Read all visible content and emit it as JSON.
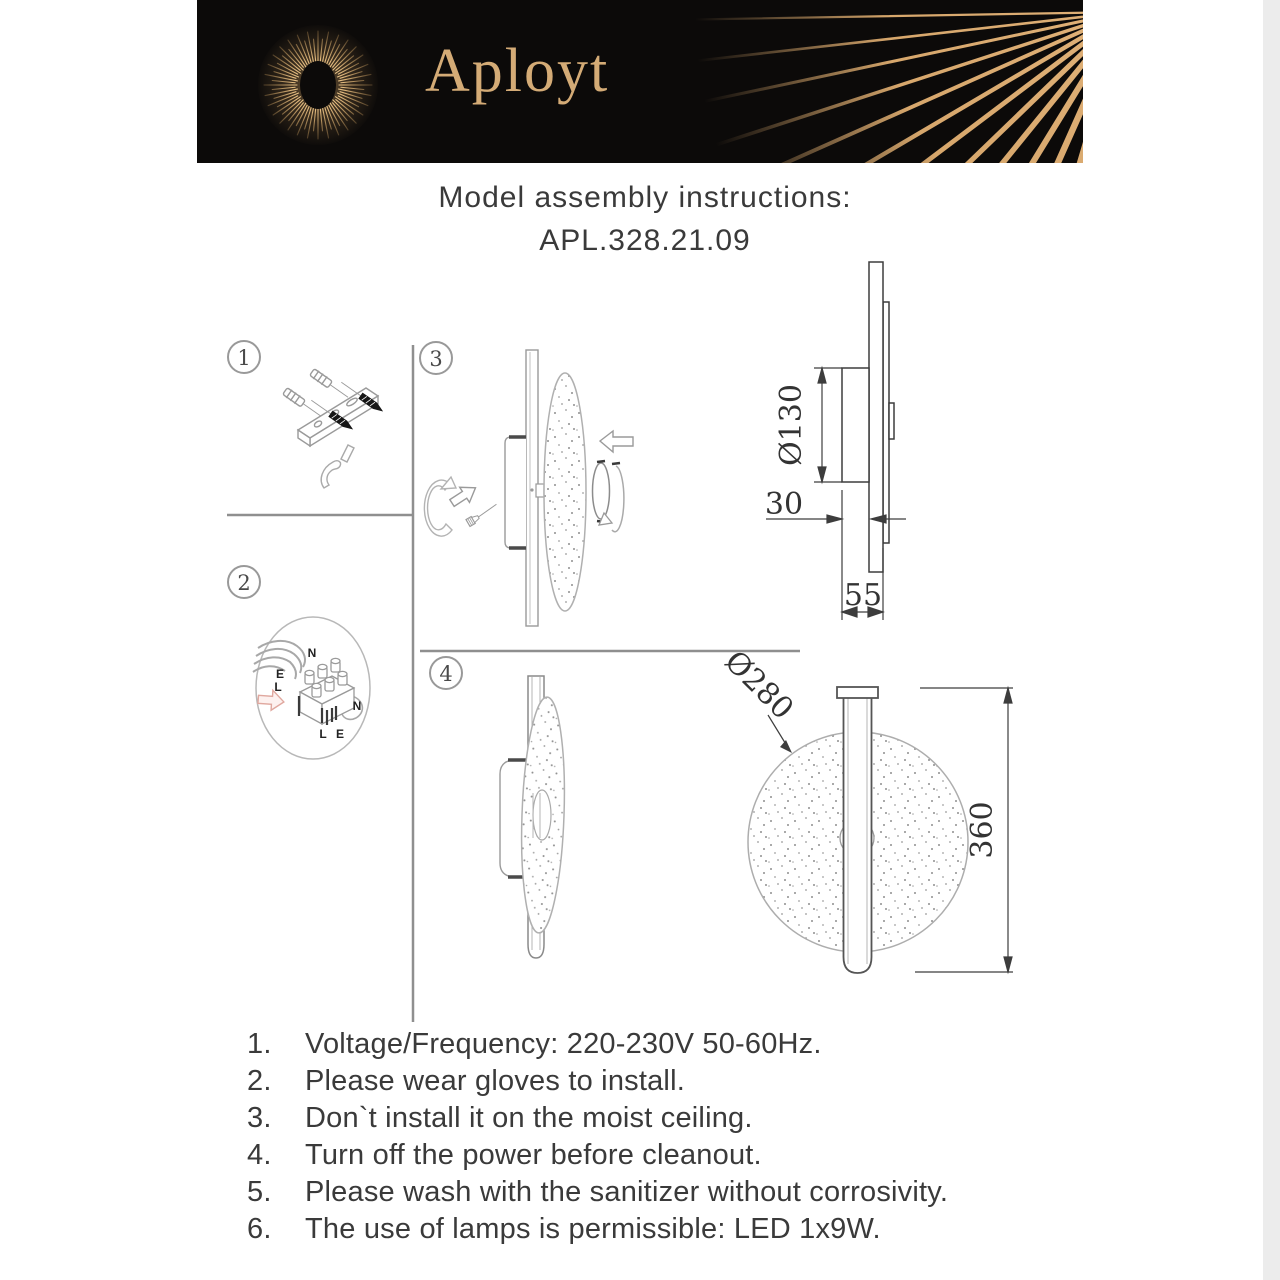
{
  "brand": {
    "logo_text": "Aployt"
  },
  "title": {
    "line1": "Model assembly instructions:",
    "line2": "APL.328.21.09"
  },
  "steps": {
    "s1": "1",
    "s2": "2",
    "s3": "3",
    "s4": "4"
  },
  "wiring_labels": {
    "n_top": "N",
    "e_left": "E",
    "l_left": "L",
    "n_right": "N",
    "l_bottom": "L",
    "e_bottom": "E"
  },
  "dimensions": {
    "mount_diameter": "Ø130",
    "mount_depth": "30",
    "total_depth": "55",
    "shade_diameter": "Ø280",
    "total_height": "360"
  },
  "instructions": {
    "items": [
      {
        "num": "1.",
        "text": "Voltage/Frequency: 220-230V 50-60Hz."
      },
      {
        "num": "2.",
        "text": "Please wear gloves to install."
      },
      {
        "num": "3.",
        "text": "Don`t install it on the moist ceiling."
      },
      {
        "num": "4.",
        "text": "Turn off the power before cleanout."
      },
      {
        "num": "5.",
        "text": "Please wash with the sanitizer without corrosivity."
      },
      {
        "num": "6.",
        "text": "The use of lamps is permissible: LED 1x9W."
      }
    ]
  },
  "colors": {
    "gold": "#d7a76c",
    "header_bg": "#0c0a09",
    "line_gray": "#9a9a9a",
    "dark_line": "#3d3d3d",
    "text": "#3a3a3a"
  }
}
